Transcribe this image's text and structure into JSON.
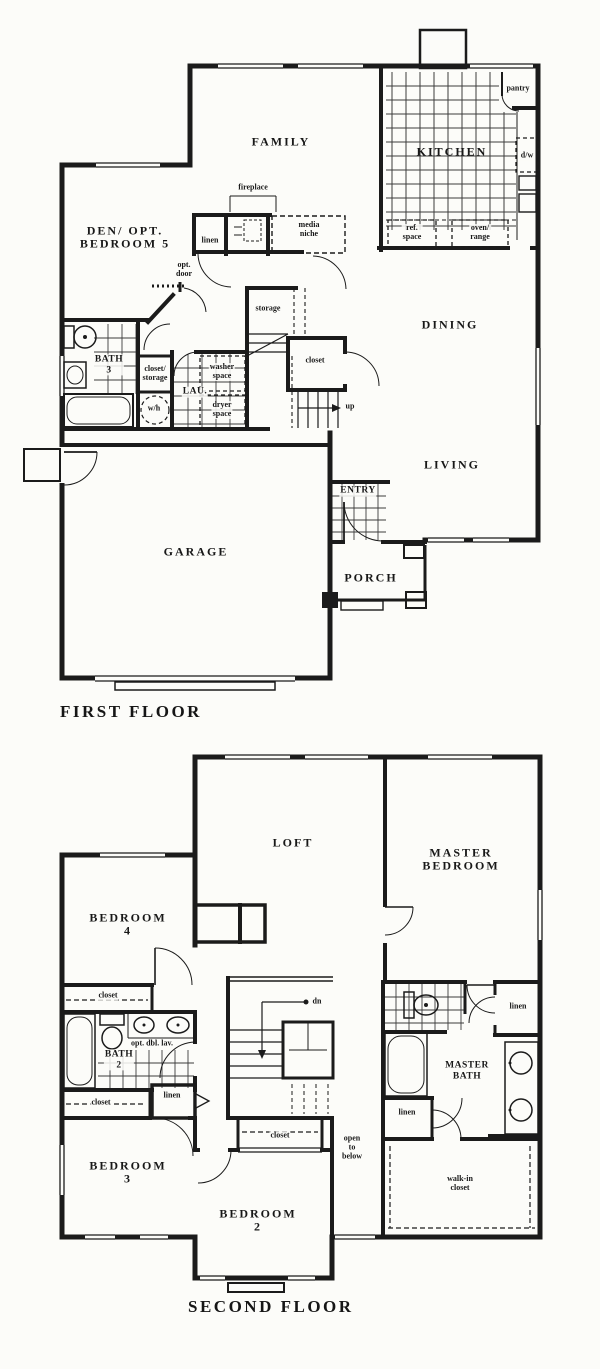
{
  "document": {
    "kind": "house floor plan drawing",
    "floors_shown": 2
  },
  "colors": {
    "ink": "#1b1b1b",
    "paper": "#fcfcf9",
    "tile_grid": "#3c3c3c"
  },
  "first_floor": {
    "title": "FIRST FLOOR",
    "labels": {
      "family": "FAMILY",
      "kitchen": "KITCHEN",
      "pantry": "pantry",
      "dw": "d/w",
      "fireplace": "fireplace",
      "den": "DEN/ OPT.\nBEDROOM 5",
      "linen": "linen",
      "media_niche": "media\nniche",
      "ref_space": "ref.\nspace",
      "oven_range": "oven/\nrange",
      "opt_door": "opt.\ndoor",
      "storage": "storage",
      "dining": "DINING",
      "closet": "closet",
      "bath3": "BATH\n3",
      "closet_storage": "closet/\nstorage",
      "laundry": "LAU.",
      "washer_space": "washer\nspace",
      "dryer_space": "dryer\nspace",
      "water_heater": "w/h",
      "up": "up",
      "living": "LIVING",
      "entry": "ENTRY",
      "garage": "GARAGE",
      "porch": "PORCH"
    }
  },
  "second_floor": {
    "title": "SECOND FLOOR",
    "labels": {
      "loft": "LOFT",
      "master_bedroom": "MASTER\nBEDROOM",
      "bedroom4": "BEDROOM\n4",
      "closet": "closet",
      "bath2": "BATH\n2",
      "opt_dbl_lav": "opt. dbl. lav.",
      "dn": "dn",
      "linen": "linen",
      "master_bath": "MASTER\nBATH",
      "open_to_below": "open\nto\nbelow",
      "bedroom3": "BEDROOM\n3",
      "bedroom2": "BEDROOM\n2",
      "walk_in_closet": "walk-in\ncloset"
    }
  }
}
